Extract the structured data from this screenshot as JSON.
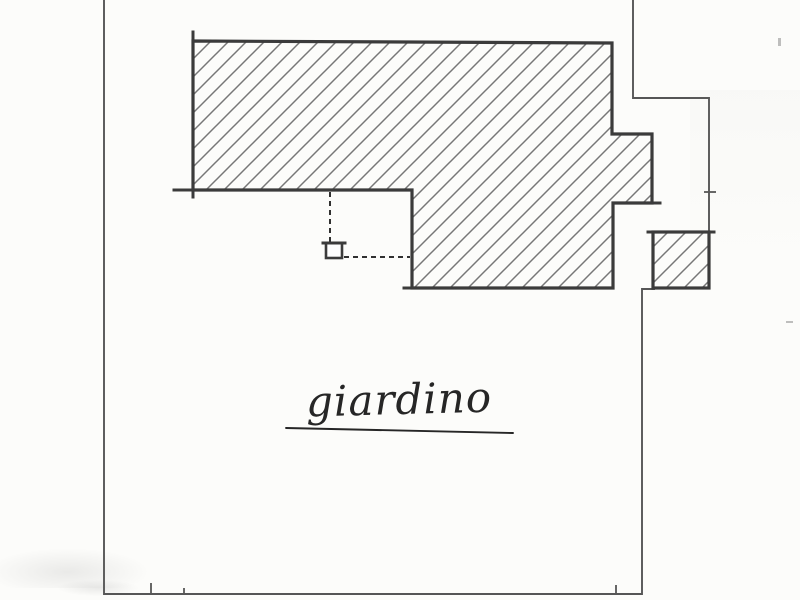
{
  "document": {
    "kind": "Scanned hand-drawn cadastral site plan",
    "language": "Italian"
  },
  "labels": {
    "garden": "giardino"
  },
  "colors": {
    "paper": "#fcfcfa",
    "ink_heavy": "#3b3b3b",
    "ink_thin": "#565656",
    "hatch": "#777777",
    "dashed": "#303030",
    "text_ink": "#262626"
  },
  "plan": {
    "boundary_left_bottom": [
      [
        104,
        0
      ],
      [
        104,
        594
      ],
      [
        642,
        594
      ],
      [
        642,
        289
      ],
      [
        654,
        289
      ]
    ],
    "boundary_right_top": [
      [
        633,
        0
      ],
      [
        633,
        98
      ],
      [
        709,
        98
      ],
      [
        709,
        288
      ]
    ],
    "building_footprint": [
      [
        193,
        41
      ],
      [
        612,
        43
      ],
      [
        612,
        134
      ],
      [
        652,
        134
      ],
      [
        652,
        203
      ],
      [
        613,
        203
      ],
      [
        613,
        288
      ],
      [
        412,
        288
      ],
      [
        412,
        190
      ],
      [
        193,
        190
      ]
    ],
    "annex": {
      "x": 653,
      "y": 232,
      "width": 56,
      "height": 56
    },
    "well_symbol": {
      "x": 326,
      "y": 243,
      "width": 16,
      "height": 15
    },
    "dashed_reference_lines": [
      [
        [
          330,
          192
        ],
        [
          330,
          242
        ]
      ],
      [
        [
          344,
          257
        ],
        [
          410,
          257
        ]
      ]
    ],
    "label_underline": [
      [
        286,
        428
      ],
      [
        513,
        433
      ]
    ],
    "tick_marks": [
      {
        "x1": 151,
        "y1": 583,
        "x2": 151,
        "y2": 595,
        "heavy": false
      },
      {
        "x1": 184,
        "y1": 588,
        "x2": 184,
        "y2": 595,
        "heavy": false
      },
      {
        "x1": 616,
        "y1": 585,
        "x2": 616,
        "y2": 594,
        "heavy": false
      },
      {
        "x1": 704,
        "y1": 192,
        "x2": 716,
        "y2": 192,
        "heavy": false
      },
      {
        "x1": 193,
        "y1": 32,
        "x2": 193,
        "y2": 46,
        "heavy": true
      },
      {
        "x1": 193,
        "y1": 186,
        "x2": 193,
        "y2": 197,
        "heavy": true
      },
      {
        "x1": 174,
        "y1": 190,
        "x2": 194,
        "y2": 190,
        "heavy": true
      },
      {
        "x1": 404,
        "y1": 288,
        "x2": 414,
        "y2": 288,
        "heavy": true
      },
      {
        "x1": 652,
        "y1": 203,
        "x2": 660,
        "y2": 203,
        "heavy": true
      },
      {
        "x1": 648,
        "y1": 232,
        "x2": 714,
        "y2": 232,
        "heavy": true
      },
      {
        "x1": 323,
        "y1": 243,
        "x2": 345,
        "y2": 243,
        "heavy": true
      }
    ],
    "scan_specks": [
      {
        "x": 778,
        "y": 38,
        "w": 3,
        "h": 8
      },
      {
        "x": 786,
        "y": 321,
        "w": 7,
        "h": 2
      }
    ]
  }
}
